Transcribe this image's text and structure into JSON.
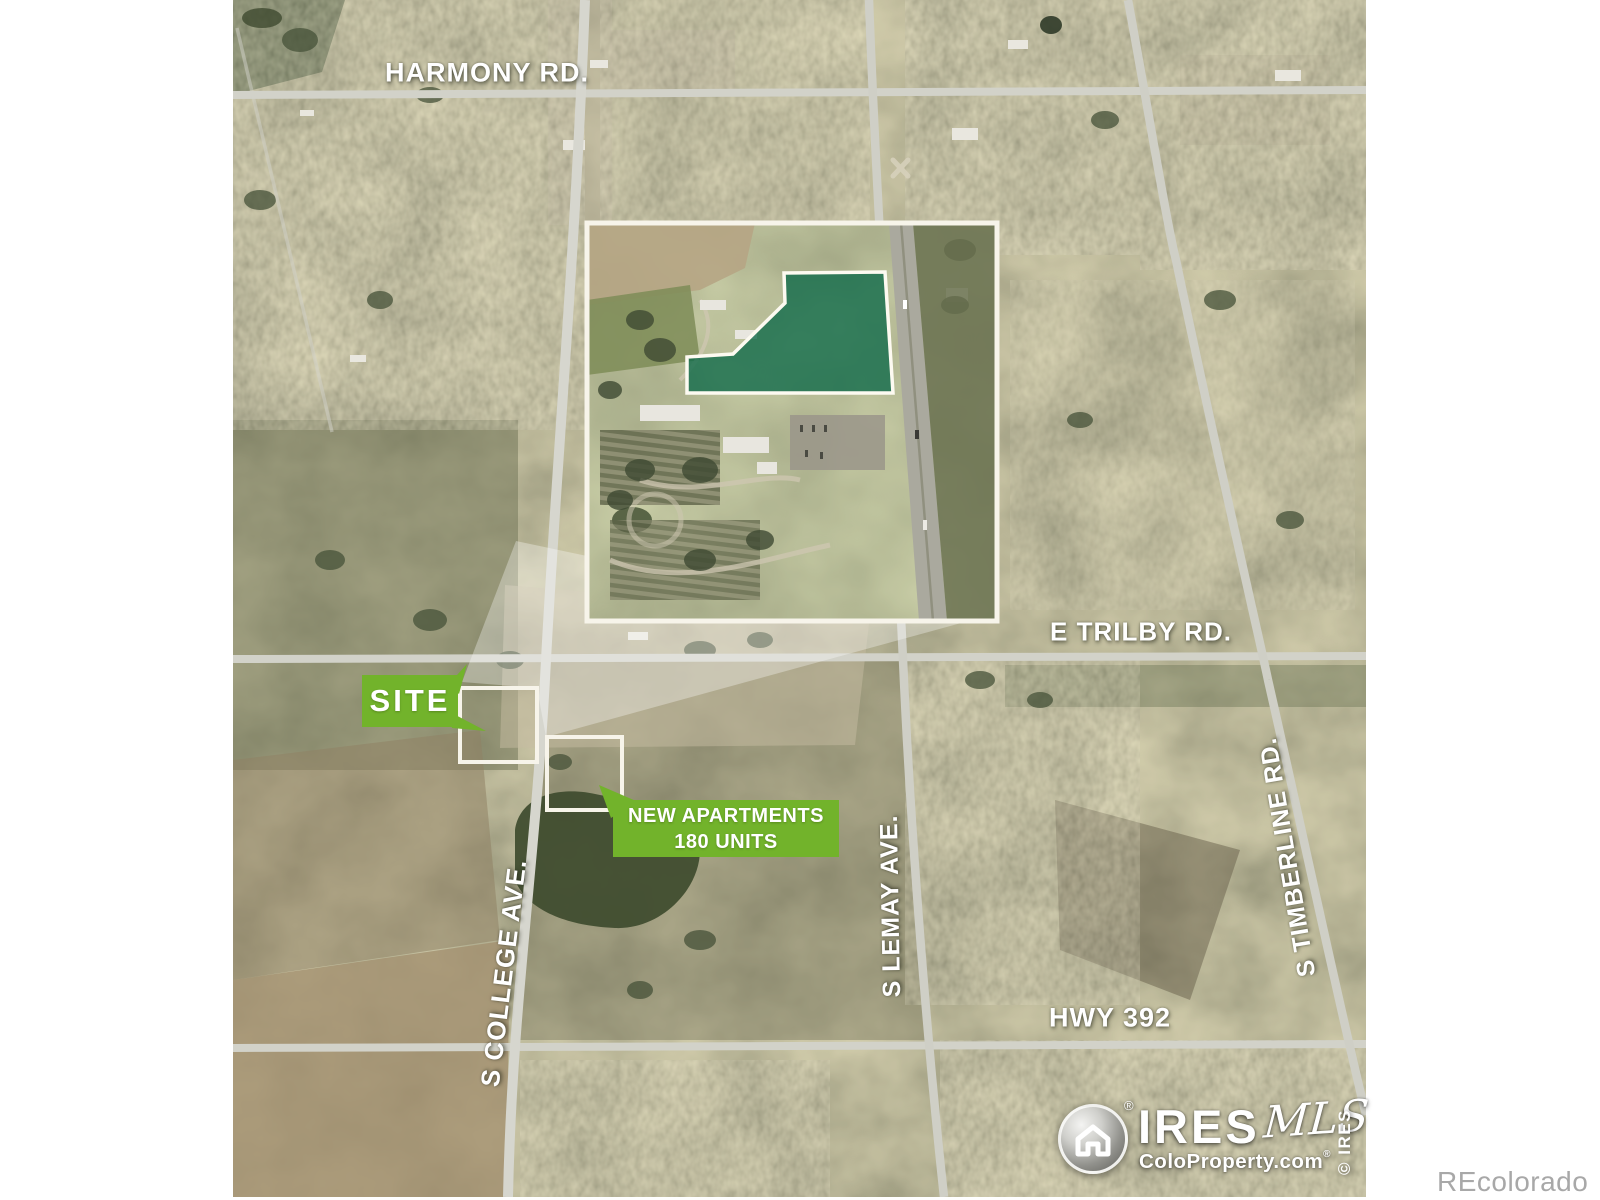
{
  "labels": {
    "harmony": "HARMONY RD.",
    "trilby": "E TRILBY RD.",
    "college": "S COLLEGE AVE.",
    "lemay": "S LEMAY AVE.",
    "timberline": "S TIMBERLINE RD.",
    "hwy392": "HWY 392"
  },
  "callouts": {
    "site": {
      "label": "SITE"
    },
    "apartments": {
      "line1": "NEW APARTMENTS",
      "line2": "180 UNITS"
    }
  },
  "watermarks": {
    "ires": {
      "brand": "IRES",
      "script": "MLS",
      "reg": "®",
      "tagline": "ColoProperty.com",
      "tagline_reg": "®",
      "copyright": "© IRES"
    },
    "recolorado": "REcolorado"
  },
  "colors": {
    "accent_green": "#72b32b",
    "parcel_green": "#106a4a",
    "label_white": "#ffffff",
    "watermark_gray": "#a8a8a8",
    "road_gray": "#d2d2c9"
  }
}
